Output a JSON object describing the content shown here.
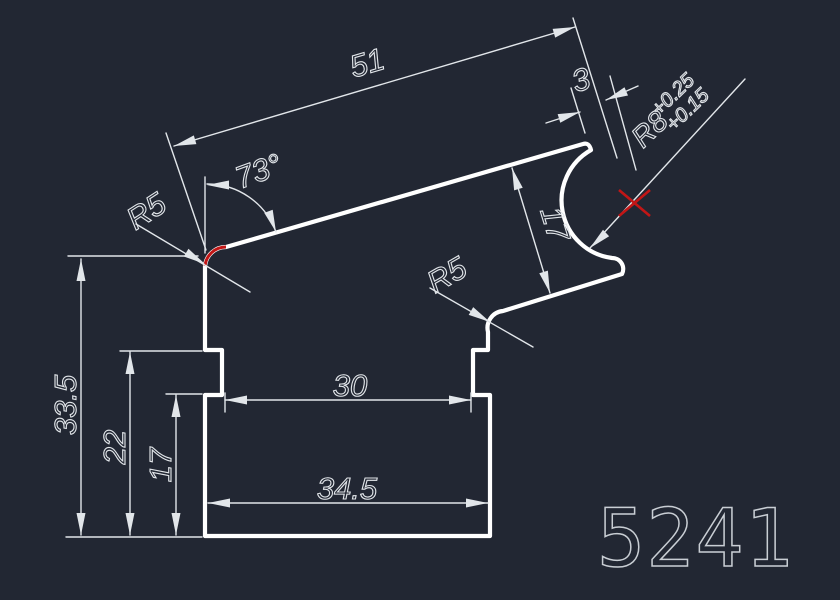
{
  "canvas": {
    "background": "#222733",
    "profile_color": "#ffffff",
    "dim_color": "#e2e6ea",
    "accent_red": "#c21616",
    "part_number_color": "#c9ced4"
  },
  "drawing": {
    "part_number": "5241",
    "dimensions": {
      "top_length": "51",
      "top_offset": "3",
      "corner_angle": "73°",
      "fillet_top_left": "R5",
      "cove_radius": "R8",
      "cove_tol_upper": "+0.25",
      "cove_tol_lower": "+0.15",
      "slant_thickness": "17",
      "fillet_right": "R5",
      "total_height": "33.5",
      "shoulder_height": "22",
      "base_height": "17",
      "neck_width": "30",
      "base_width": "34.5"
    }
  },
  "arrows": [
    [
      174,
      146,
      163.5
    ],
    [
      575,
      27,
      -16.5
    ],
    [
      580,
      112,
      -17
    ],
    [
      606,
      100,
      157
    ],
    [
      207,
      185,
      180
    ],
    [
      276,
      232,
      70
    ],
    [
      205,
      264,
      31
    ],
    [
      512,
      168,
      -107
    ],
    [
      550,
      293,
      73
    ],
    [
      490,
      322,
      30
    ],
    [
      590,
      248,
      137
    ],
    [
      81,
      259,
      -90
    ],
    [
      81,
      535,
      90
    ],
    [
      130,
      352,
      -90
    ],
    [
      130,
      535,
      90
    ],
    [
      176,
      395,
      -90
    ],
    [
      176,
      535,
      90
    ],
    [
      225,
      400,
      180
    ],
    [
      471,
      400,
      0
    ],
    [
      208,
      503,
      180
    ],
    [
      488,
      503,
      0
    ]
  ]
}
